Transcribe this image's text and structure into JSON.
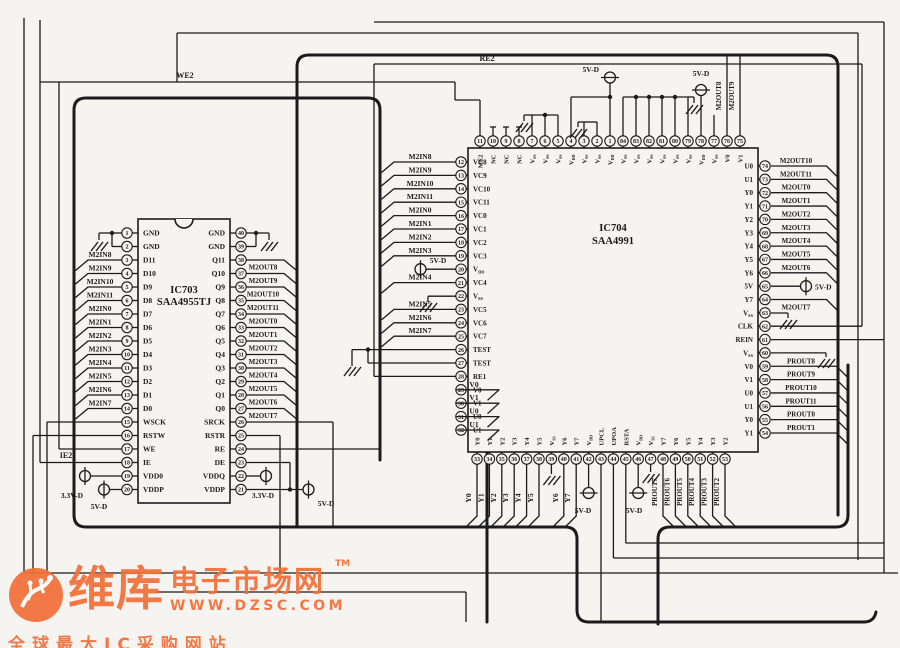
{
  "diagram": {
    "background": "#f5f4f0",
    "line_color": "#1b1b1b",
    "net_labels": [
      {
        "text": "WE2",
        "x": 185,
        "y": 78
      },
      {
        "text": "RE2",
        "x": 487,
        "y": 61
      },
      {
        "text": "IE2",
        "x": 66,
        "y": 458
      }
    ],
    "ic703": {
      "ref": "IC703",
      "part": "SAA4955TJ",
      "left_pins": [
        {
          "num": 1,
          "name": "GND"
        },
        {
          "num": 2,
          "name": "GND"
        },
        {
          "num": 3,
          "name": "D11",
          "signal": "M2IN8"
        },
        {
          "num": 4,
          "name": "D10",
          "signal": "M2IN9"
        },
        {
          "num": 5,
          "name": "D9",
          "signal": "M2IN10"
        },
        {
          "num": 6,
          "name": "D8",
          "signal": "M2IN11"
        },
        {
          "num": 7,
          "name": "D7",
          "signal": "M2IN0"
        },
        {
          "num": 8,
          "name": "D6",
          "signal": "M2IN1"
        },
        {
          "num": 9,
          "name": "D5",
          "signal": "M2IN2"
        },
        {
          "num": 10,
          "name": "D4",
          "signal": "M2IN3"
        },
        {
          "num": 11,
          "name": "D3",
          "signal": "M2IN4"
        },
        {
          "num": 12,
          "name": "D2",
          "signal": "M2IN5"
        },
        {
          "num": 13,
          "name": "D1",
          "signal": "M2IN6"
        },
        {
          "num": 14,
          "name": "D0",
          "signal": "M2IN7"
        },
        {
          "num": 15,
          "name": "WSCK"
        },
        {
          "num": 16,
          "name": "RSTW"
        },
        {
          "num": 17,
          "name": "WE"
        },
        {
          "num": 18,
          "name": "IE"
        },
        {
          "num": 19,
          "name": "VDD0",
          "supply": "3.3V-D"
        },
        {
          "num": 20,
          "name": "VDDP",
          "supply": "5V-D"
        }
      ],
      "right_pins": [
        {
          "num": 40,
          "name": "GND"
        },
        {
          "num": 39,
          "name": "GND"
        },
        {
          "num": 38,
          "name": "Q11",
          "signal": "M2OUT8"
        },
        {
          "num": 37,
          "name": "Q10",
          "signal": "M2OUT9"
        },
        {
          "num": 36,
          "name": "Q9",
          "signal": "M2OUT10"
        },
        {
          "num": 35,
          "name": "Q8",
          "signal": "M2OUT11"
        },
        {
          "num": 34,
          "name": "Q7",
          "signal": "M2OUT0"
        },
        {
          "num": 33,
          "name": "Q6",
          "signal": "M2OUT1"
        },
        {
          "num": 32,
          "name": "Q5",
          "signal": "M2OUT2"
        },
        {
          "num": 31,
          "name": "Q4",
          "signal": "M2OUT3"
        },
        {
          "num": 30,
          "name": "Q3",
          "signal": "M2OUT4"
        },
        {
          "num": 29,
          "name": "Q2",
          "signal": "M2OUT5"
        },
        {
          "num": 28,
          "name": "Q1",
          "signal": "M2OUT6"
        },
        {
          "num": 27,
          "name": "Q0",
          "signal": "M2OUT7"
        },
        {
          "num": 26,
          "name": "SRCK"
        },
        {
          "num": 25,
          "name": "RSTR"
        },
        {
          "num": 24,
          "name": "RE"
        },
        {
          "num": 23,
          "name": "DE"
        },
        {
          "num": 22,
          "name": "VDDQ",
          "supply": "3.3V-D"
        },
        {
          "num": 21,
          "name": "VDDP",
          "supply": "5V-D"
        }
      ]
    },
    "ic704": {
      "ref": "IC704",
      "part": "SAA4991",
      "left_pins": [
        {
          "num": 12,
          "name": "VC8",
          "signal": "M2IN8"
        },
        {
          "num": 13,
          "name": "VC9",
          "signal": "M2IN9"
        },
        {
          "num": 14,
          "name": "VC10",
          "signal": "M2IN10"
        },
        {
          "num": 15,
          "name": "VC11",
          "signal": "M2IN11"
        },
        {
          "num": 16,
          "name": "VC0",
          "signal": "M2IN0"
        },
        {
          "num": 17,
          "name": "VC1",
          "signal": "M2IN1"
        },
        {
          "num": 18,
          "name": "VC2",
          "signal": "M2IN2"
        },
        {
          "num": 19,
          "name": "VC3",
          "signal": "M2IN3"
        },
        {
          "num": 20,
          "name": "VDD",
          "supply": "5V-D"
        },
        {
          "num": 21,
          "name": "VC4",
          "signal": "M2IN4"
        },
        {
          "num": 22,
          "name": "Vss"
        },
        {
          "num": 23,
          "name": "VC5",
          "signal": "M2IN5"
        },
        {
          "num": 24,
          "name": "VC6",
          "signal": "M2IN6"
        },
        {
          "num": 25,
          "name": "VC7",
          "signal": "M2IN7"
        },
        {
          "num": 26,
          "name": "TEST"
        },
        {
          "num": 27,
          "name": "TEST"
        },
        {
          "num": 28,
          "name": "RE1"
        },
        {
          "num": 29,
          "name": "V0",
          "signal": "V0"
        },
        {
          "num": 30,
          "name": "V1",
          "signal": "V1"
        },
        {
          "num": 31,
          "name": "U0",
          "signal": "U0"
        },
        {
          "num": 32,
          "name": "U1",
          "signal": "U1"
        }
      ],
      "top_pins": [
        {
          "num": 11,
          "name": "ME2"
        },
        {
          "num": 10,
          "name": "NC"
        },
        {
          "num": 9,
          "name": "NC"
        },
        {
          "num": 8,
          "name": "NC"
        },
        {
          "num": 7,
          "name": "Vss"
        },
        {
          "num": 6,
          "name": "Vss"
        },
        {
          "num": 5,
          "name": "Vss"
        },
        {
          "num": 4,
          "name": "VDD"
        },
        {
          "num": 3,
          "name": "Vss"
        },
        {
          "num": 2,
          "name": "Vss"
        },
        {
          "num": 1,
          "name": "VDD",
          "supply": "5V-D"
        },
        {
          "num": 84,
          "name": "Vss"
        },
        {
          "num": 83,
          "name": "Vss"
        },
        {
          "num": 82,
          "name": "Vss"
        },
        {
          "num": 81,
          "name": "Vss"
        },
        {
          "num": 80,
          "name": "Vss"
        },
        {
          "num": 79,
          "name": "Vss"
        },
        {
          "num": 78,
          "name": "VDD",
          "supply": "5V-D"
        },
        {
          "num": 77,
          "name": "Vss"
        },
        {
          "num": 76,
          "name": "V0",
          "signal": "M2OUT8"
        },
        {
          "num": 75,
          "name": "V1",
          "signal": "M2OUT9"
        }
      ],
      "right_pins": [
        {
          "num": 74,
          "name": "U0",
          "signal": "M2OUT10"
        },
        {
          "num": 73,
          "name": "U1",
          "signal": "M2OUT11"
        },
        {
          "num": 72,
          "name": "Y0",
          "signal": "M2OUT0"
        },
        {
          "num": 71,
          "name": "Y1",
          "signal": "M2OUT1"
        },
        {
          "num": 70,
          "name": "Y2",
          "signal": "M2OUT2"
        },
        {
          "num": 69,
          "name": "Y3",
          "signal": "M2OUT3"
        },
        {
          "num": 68,
          "name": "Y4",
          "signal": "M2OUT4"
        },
        {
          "num": 67,
          "name": "Y5",
          "signal": "M2OUT5"
        },
        {
          "num": 66,
          "name": "Y6",
          "signal": "M2OUT6"
        },
        {
          "num": 65,
          "name": "5V",
          "supply": "5V-D"
        },
        {
          "num": 64,
          "name": "Y7",
          "signal": "M2OUT7"
        },
        {
          "num": 63,
          "name": "Vss"
        },
        {
          "num": 62,
          "name": "CLK"
        },
        {
          "num": 61,
          "name": "REIN"
        },
        {
          "num": 60,
          "name": "Vss"
        },
        {
          "num": 59,
          "name": "V0",
          "signal": "PROUT8"
        },
        {
          "num": 58,
          "name": "V1",
          "signal": "PROUT9"
        },
        {
          "num": 57,
          "name": "U0",
          "signal": "PROUT10"
        },
        {
          "num": 56,
          "name": "U1",
          "signal": "PROUT11"
        },
        {
          "num": 55,
          "name": "Y0",
          "signal": "PROUT0"
        },
        {
          "num": 54,
          "name": "Y1",
          "signal": "PROUT1"
        }
      ],
      "bottom_pins": [
        {
          "num": 33,
          "name": "Y0",
          "signal": "Y0"
        },
        {
          "num": 34,
          "name": "Y1",
          "signal": "Y1"
        },
        {
          "num": 35,
          "name": "Y2",
          "signal": "Y2"
        },
        {
          "num": 36,
          "name": "Y3",
          "signal": "Y3"
        },
        {
          "num": 37,
          "name": "Y4",
          "signal": "Y4"
        },
        {
          "num": 38,
          "name": "Y5",
          "signal": "Y5"
        },
        {
          "num": 39,
          "name": "Vss"
        },
        {
          "num": 40,
          "name": "Y6",
          "signal": "Y6"
        },
        {
          "num": 41,
          "name": "Y7",
          "signal": "Y7"
        },
        {
          "num": 42,
          "name": "VDD",
          "supply": "5V-D"
        },
        {
          "num": 43,
          "name": "UPCL"
        },
        {
          "num": 44,
          "name": "UPOA"
        },
        {
          "num": 45,
          "name": "RSTA"
        },
        {
          "num": 46,
          "name": "VDD",
          "supply": "5V-D"
        },
        {
          "num": 47,
          "name": "Vss"
        },
        {
          "num": 48,
          "name": "Y7",
          "signal": "PROUT7"
        },
        {
          "num": 49,
          "name": "Y6",
          "signal": "PROUT6"
        },
        {
          "num": 50,
          "name": "Y5",
          "signal": "PROUT5"
        },
        {
          "num": 51,
          "name": "Y4",
          "signal": "PROUT4"
        },
        {
          "num": 52,
          "name": "Y3",
          "signal": "PROUT3"
        },
        {
          "num": 53,
          "name": "Y2",
          "signal": "PROUT2"
        }
      ]
    }
  },
  "watermark": {
    "brand_cn": "维库",
    "brand_suffix": "电子市场网",
    "tm": "TM",
    "url": "WWW.DZSC.COM",
    "tagline": "全球最大IC采购网站",
    "color": "#f2703a"
  }
}
